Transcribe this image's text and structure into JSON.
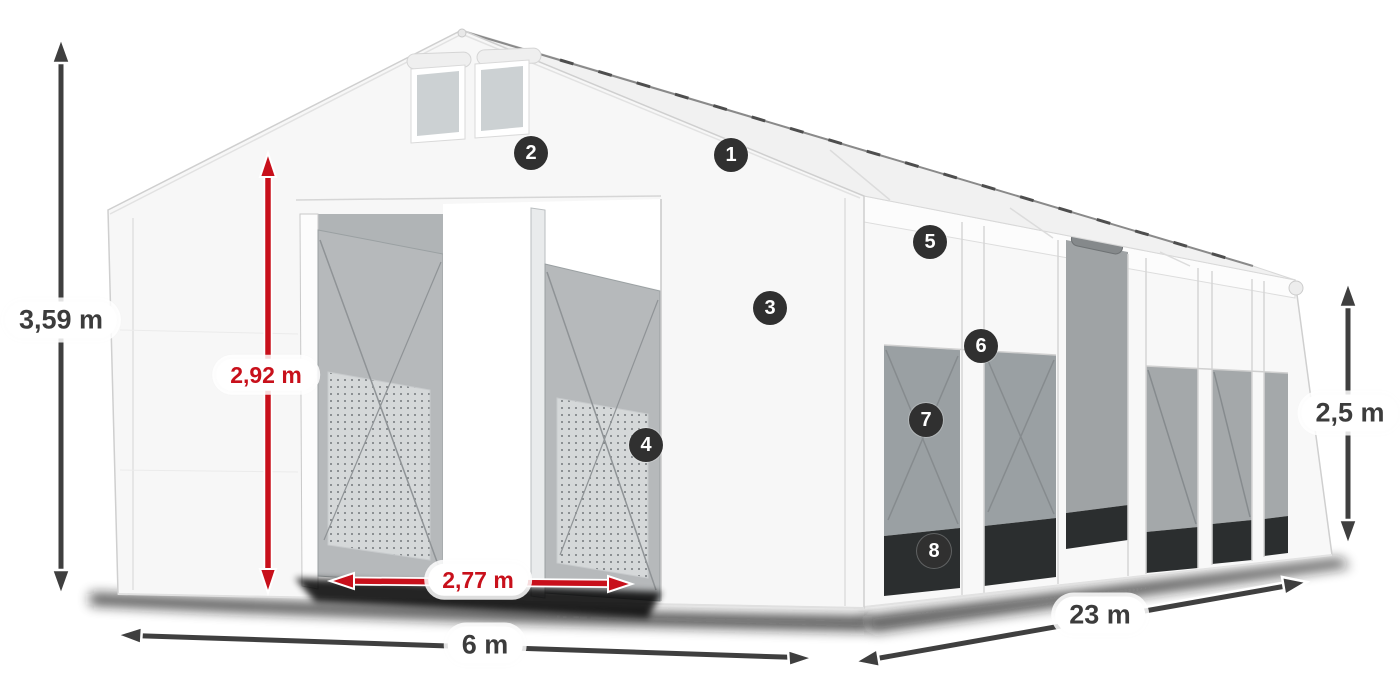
{
  "diagram": {
    "subject": "storage-tent-dimensions-diagram"
  },
  "dimensions": {
    "total_height": "3,59 m",
    "door_height": "2,92 m",
    "door_width": "2,77 m",
    "front_width": "6 m",
    "length": "23 m",
    "side_height": "2,5 m"
  },
  "callouts": {
    "numbers": [
      "1",
      "2",
      "3",
      "4",
      "5",
      "6",
      "7",
      "8"
    ]
  },
  "colors": {
    "dimension_dark": "#3f3f3f",
    "dimension_red": "#c8101b",
    "badge_background": "#303030",
    "badge_text": "#ffffff",
    "tent_white": "#f7f7f7",
    "mesh_gray": "#b6b9bb"
  }
}
